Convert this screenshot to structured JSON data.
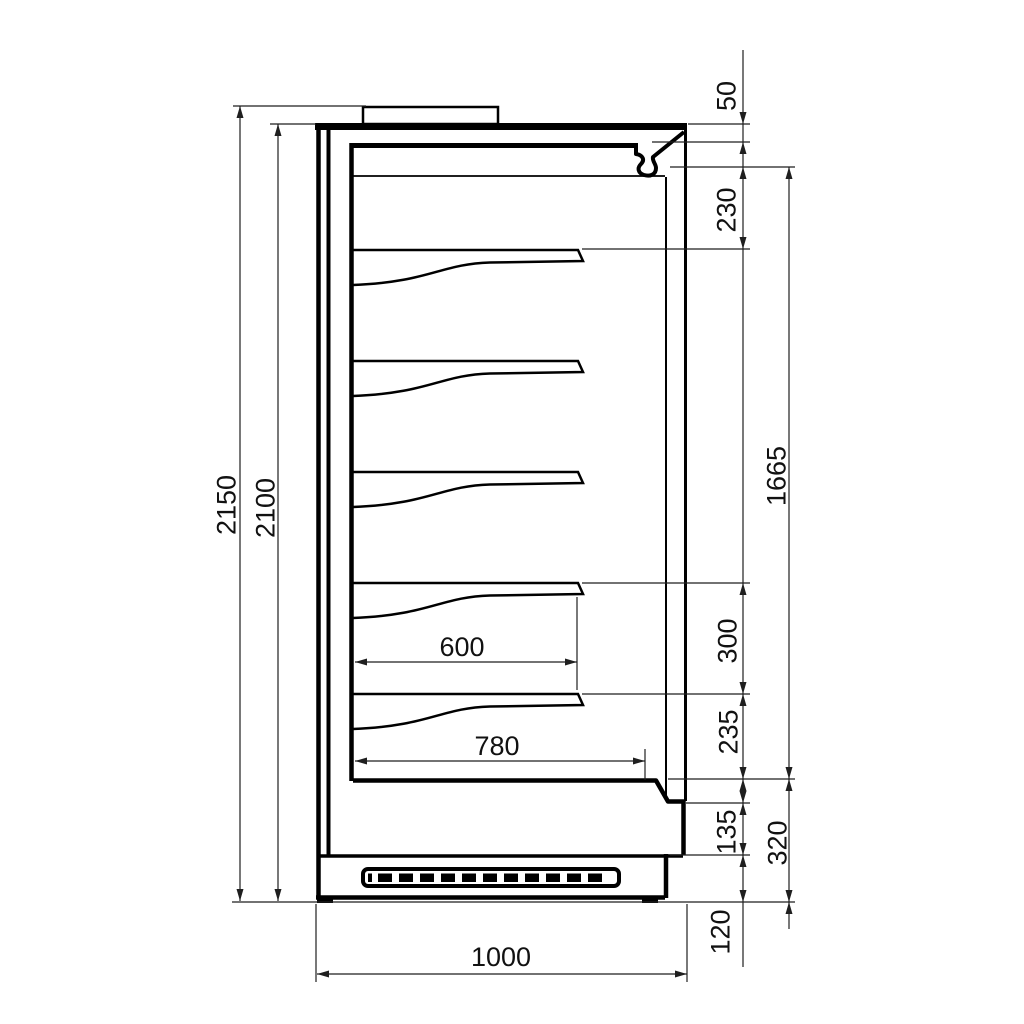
{
  "dimensions": {
    "left": {
      "overall_height": "2150",
      "body_height": "2100"
    },
    "right": {
      "top_panel": "50",
      "canopy": "230",
      "display_opening": "1665",
      "shelf_spacing": "300",
      "shelf_to_deck": "235",
      "front_step": "135",
      "base_section": "320",
      "plinth": "120"
    },
    "internal": {
      "shelf_depth": "600",
      "deck_depth": "780"
    },
    "bottom": {
      "overall_depth": "1000"
    }
  }
}
